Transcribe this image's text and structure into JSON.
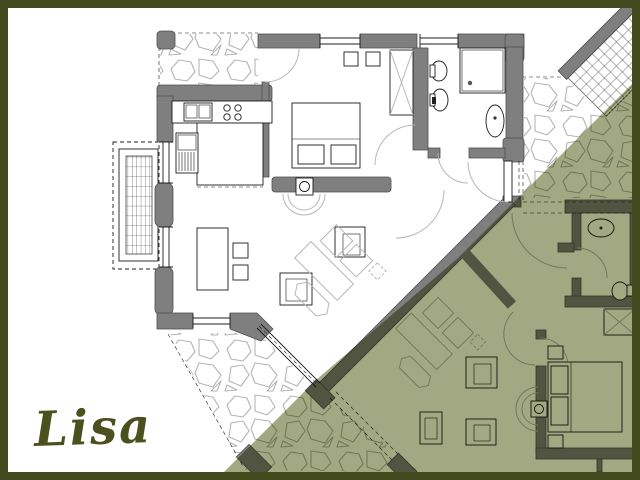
{
  "title": {
    "text": "Lisa"
  },
  "colors": {
    "frame": "#42491c",
    "background": "#ffffff",
    "wall_fill": "#7f7f7f",
    "wall_edge": "#505050",
    "line": "#1c1c1c",
    "light_line": "#b6b6b6",
    "stone_line": "#b4b4b4",
    "neighbor_overlay": "#9aa176",
    "title_color": "#4a501e"
  }
}
